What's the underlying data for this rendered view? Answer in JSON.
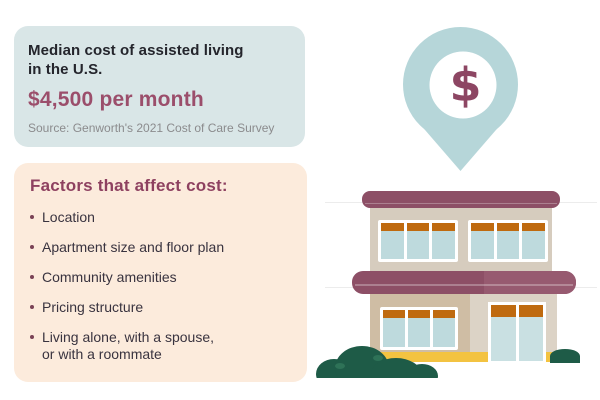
{
  "cost_card": {
    "title": "Median cost of assisted living\nin the U.S.",
    "amount": "$4,500 per month",
    "source": "Source: Genworth's 2021 Cost of Care Survey"
  },
  "factors_card": {
    "heading": "Factors that affect cost:",
    "items": [
      "Location",
      "Apartment size and floor plan",
      "Community amenities",
      "Pricing structure",
      "Living alone, with a spouse,\nor with a roommate"
    ]
  },
  "illustration": {
    "pin_symbol": "$",
    "icons": [
      "map-pin-icon",
      "dollar-sign",
      "building-illustration",
      "bush-left",
      "bush-right"
    ]
  },
  "colors": {
    "cost_card_bg": "#d9e6e7",
    "factors_card_bg": "#fcebdc",
    "accent_maroon": "#8d4f66",
    "amount_text": "#9b4e6b",
    "heading_text": "#8e4160",
    "body_text": "#39333f",
    "source_text": "#8b8b8d",
    "pin_blue": "#b6d6d9",
    "wall_tan": "#d6ccbe",
    "window_orange": "#bf6a0f",
    "window_glass": "#bedadd",
    "base_yellow": "#f3c341",
    "bush_green": "#1e5b47"
  }
}
